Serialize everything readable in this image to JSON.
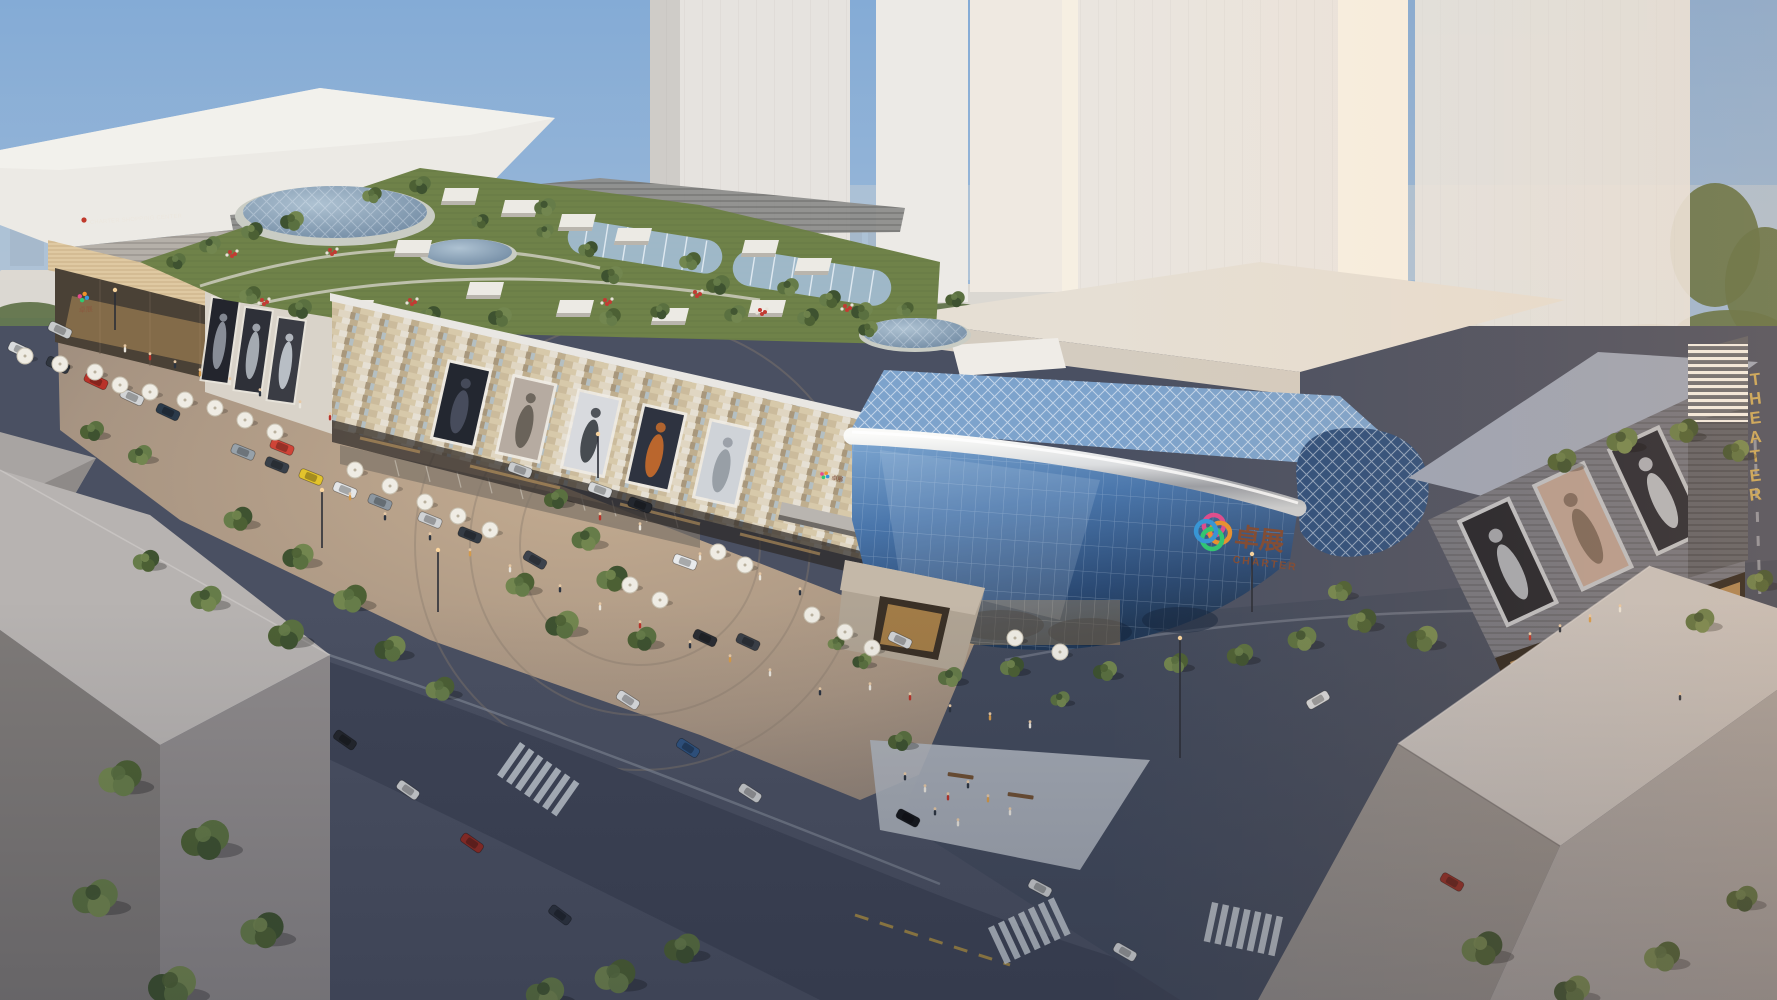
{
  "scene": {
    "signs": {
      "left_building": "CHARTER SHOPPING CENTER",
      "glass_logo_cn": "卓展",
      "glass_logo_en": "CHARTER",
      "theater_vertical": "THEATER"
    },
    "palette": {
      "sky_top": "#84abd6",
      "sky_horizon": "#d9dde0",
      "tower_white": "#eae5df",
      "tower_sunlit": "#f7f0e3",
      "facade_beige": "#cdbd9e",
      "glass_blue": "#3c6399",
      "chrome": "#c9ccd0",
      "roof_green": "#6f8249",
      "plaza_warm": "#b49d8a",
      "asphalt": "#454c5e",
      "gold_sign": "#c9a85c",
      "logo_bronze": "#7e4a34",
      "logo_ring_colors": [
        "#e64a8d",
        "#f0932b",
        "#2ecc71",
        "#3498db"
      ],
      "tree_greens": [
        "#4c6034",
        "#5a7040",
        "#667c49",
        "#3e5230",
        "#72864f"
      ],
      "people_colors": [
        "#e9e5dc",
        "#b93229",
        "#2c3440",
        "#d49a4a",
        "#e9e5dc",
        "#2c3440"
      ]
    },
    "skyline": [
      [
        10,
        222,
        34,
        44
      ],
      [
        52,
        236,
        26,
        30
      ],
      [
        90,
        218,
        20,
        48
      ],
      [
        118,
        238,
        30,
        28
      ],
      [
        155,
        228,
        22,
        38
      ],
      [
        185,
        214,
        16,
        52
      ],
      [
        210,
        234,
        28,
        32
      ],
      [
        245,
        222,
        20,
        44
      ],
      [
        278,
        236,
        26,
        30
      ],
      [
        310,
        226,
        18,
        40
      ],
      [
        340,
        232,
        24,
        34
      ],
      [
        378,
        218,
        16,
        48
      ],
      [
        402,
        234,
        26,
        32
      ],
      [
        438,
        224,
        18,
        42
      ],
      [
        462,
        230,
        22,
        36
      ],
      [
        495,
        236,
        26,
        30
      ],
      [
        530,
        222,
        16,
        44
      ],
      [
        556,
        232,
        24,
        34
      ],
      [
        592,
        226,
        18,
        40
      ],
      [
        620,
        234,
        22,
        32
      ],
      [
        836,
        230,
        26,
        36
      ],
      [
        868,
        220,
        18,
        46
      ],
      [
        896,
        234,
        26,
        32
      ],
      [
        930,
        224,
        18,
        42
      ],
      [
        1000,
        230,
        40,
        34
      ],
      [
        1048,
        236,
        24,
        30
      ]
    ],
    "mid_buildings": [
      [
        0,
        270,
        120,
        48
      ],
      [
        130,
        278,
        90,
        42
      ],
      [
        230,
        284,
        110,
        38
      ],
      [
        350,
        278,
        80,
        42
      ],
      [
        450,
        286,
        90,
        36
      ],
      [
        550,
        280,
        70,
        40
      ],
      [
        835,
        290,
        80,
        38
      ],
      [
        920,
        284,
        90,
        42
      ],
      [
        1010,
        290,
        62,
        36
      ]
    ],
    "bg_trees": [
      [
        30,
        318,
        40,
        16
      ],
      [
        110,
        322,
        50,
        18
      ],
      [
        210,
        326,
        45,
        16
      ],
      [
        320,
        324,
        48,
        17
      ],
      [
        430,
        322,
        42,
        15
      ],
      [
        540,
        324,
        46,
        16
      ],
      [
        620,
        322,
        38,
        14
      ],
      [
        850,
        324,
        44,
        16
      ],
      [
        950,
        320,
        48,
        17
      ],
      [
        1040,
        322,
        40,
        15
      ],
      [
        1450,
        342,
        60,
        20
      ],
      [
        1560,
        347,
        55,
        20
      ],
      [
        1650,
        342,
        50,
        18
      ],
      [
        1730,
        332,
        55,
        22
      ],
      [
        1715,
        245,
        45,
        62
      ],
      [
        1765,
        285,
        40,
        58
      ]
    ],
    "skylights": [
      [
        445,
        188
      ],
      [
        505,
        200
      ],
      [
        562,
        214
      ],
      [
        618,
        228
      ],
      [
        745,
        240
      ],
      [
        798,
        258
      ],
      [
        470,
        282
      ],
      [
        560,
        300
      ],
      [
        655,
        308
      ],
      [
        752,
        300
      ],
      [
        398,
        240
      ],
      [
        340,
        300
      ]
    ],
    "roof_trees": [
      [
        176,
        262,
        0.9
      ],
      [
        210,
        246,
        1
      ],
      [
        252,
        232,
        1
      ],
      [
        292,
        222,
        1.1
      ],
      [
        372,
        196,
        0.9
      ],
      [
        420,
        186,
        1
      ],
      [
        545,
        208,
        1
      ],
      [
        588,
        250,
        0.9
      ],
      [
        612,
        276,
        1
      ],
      [
        690,
        262,
        1
      ],
      [
        718,
        286,
        1.1
      ],
      [
        788,
        288,
        1
      ],
      [
        830,
        300,
        1
      ],
      [
        862,
        312,
        1
      ],
      [
        250,
        296,
        1
      ],
      [
        300,
        310,
        1.1
      ],
      [
        360,
        318,
        1
      ],
      [
        430,
        316,
        1
      ],
      [
        500,
        318,
        1.1
      ],
      [
        610,
        318,
        1
      ],
      [
        660,
        312,
        0.9
      ],
      [
        735,
        315,
        1
      ],
      [
        808,
        318,
        1
      ],
      [
        868,
        330,
        0.9
      ],
      [
        905,
        310,
        0.8
      ],
      [
        955,
        300,
        0.9
      ],
      [
        545,
        232,
        0.8
      ],
      [
        480,
        222,
        0.8
      ]
    ],
    "flowers": [
      [
        230,
        252
      ],
      [
        262,
        300
      ],
      [
        695,
        292
      ],
      [
        845,
        306
      ],
      [
        410,
        300
      ],
      [
        330,
        250
      ],
      [
        605,
        300
      ],
      [
        760,
        310
      ]
    ],
    "billboards_left": [
      {
        "x": 213,
        "y": 298,
        "bg": "#23252d",
        "fig": "#9aa0aa"
      },
      {
        "x": 246,
        "y": 308,
        "bg": "#2e3038",
        "fig": "#b9bfc7"
      },
      {
        "x": 279,
        "y": 318,
        "bg": "#3a3c44",
        "fig": "#cfd5dc"
      }
    ],
    "billboards_main": [
      {
        "x": 450,
        "bg": "#232730",
        "fig": "#4d5464"
      },
      {
        "x": 515,
        "bg": "#b6aba1",
        "fig": "#5d564e"
      },
      {
        "x": 580,
        "bg": "#d8dade",
        "fig": "#2e3238"
      },
      {
        "x": 645,
        "bg": "#2e3340",
        "fig": "#d2702a"
      },
      {
        "x": 712,
        "bg": "#cfd3d8",
        "fig": "#8e959e"
      }
    ],
    "billboards_right": [
      {
        "x": 1462,
        "bg": "#20232c",
        "fig": "#b9bec8"
      },
      {
        "x": 1537,
        "bg": "#b49c90",
        "fig": "#6e5d52"
      },
      {
        "x": 1612,
        "bg": "#262934",
        "fig": "#c8ccd4"
      }
    ],
    "crosswalks": [
      [
        520,
        742,
        35
      ],
      [
        988,
        928,
        -25
      ],
      [
        1212,
        902,
        12
      ],
      [
        30,
        556,
        28
      ]
    ],
    "trees": [
      [
        92,
        432,
        1
      ],
      [
        140,
        456,
        1
      ],
      [
        238,
        520,
        1.2
      ],
      [
        298,
        558,
        1.3
      ],
      [
        350,
        600,
        1.4
      ],
      [
        286,
        636,
        1.5
      ],
      [
        206,
        600,
        1.3
      ],
      [
        146,
        562,
        1.1
      ],
      [
        390,
        650,
        1.3
      ],
      [
        440,
        690,
        1.2
      ],
      [
        556,
        500,
        1
      ],
      [
        586,
        540,
        1.2
      ],
      [
        612,
        580,
        1.3
      ],
      [
        562,
        626,
        1.4
      ],
      [
        520,
        586,
        1.2
      ],
      [
        642,
        640,
        1.2
      ],
      [
        950,
        678,
        1
      ],
      [
        1012,
        668,
        1
      ],
      [
        1105,
        672,
        1
      ],
      [
        1176,
        664,
        1
      ],
      [
        1240,
        656,
        1.1
      ],
      [
        1302,
        640,
        1.2
      ],
      [
        1362,
        622,
        1.2
      ],
      [
        1422,
        640,
        1.3
      ],
      [
        1340,
        592,
        1
      ],
      [
        1562,
        462,
        1.2
      ],
      [
        1622,
        442,
        1.3
      ],
      [
        1684,
        432,
        1.2
      ],
      [
        1736,
        452,
        1.1
      ],
      [
        120,
        780,
        1.8
      ],
      [
        205,
        842,
        2
      ],
      [
        95,
        900,
        1.9
      ],
      [
        262,
        932,
        1.8
      ],
      [
        172,
        988,
        2
      ],
      [
        615,
        978,
        1.7
      ],
      [
        682,
        950,
        1.5
      ],
      [
        545,
        995,
        1.6
      ],
      [
        1482,
        950,
        1.7
      ],
      [
        1572,
        992,
        1.5
      ],
      [
        1662,
        958,
        1.5
      ],
      [
        1742,
        900,
        1.3
      ],
      [
        1700,
        622,
        1.2
      ],
      [
        1760,
        582,
        1.1
      ],
      [
        862,
        662,
        0.8
      ],
      [
        836,
        644,
        0.7
      ],
      [
        900,
        742,
        1
      ],
      [
        1060,
        700,
        0.8
      ]
    ],
    "cars": [
      [
        20,
        350,
        25,
        "#d9dbdd"
      ],
      [
        58,
        365,
        25,
        "#30363f"
      ],
      [
        96,
        381,
        25,
        "#b93229"
      ],
      [
        132,
        397,
        25,
        "#d2d4d6"
      ],
      [
        168,
        412,
        25,
        "#2b3a4a"
      ],
      [
        60,
        330,
        25,
        "#c8cacb"
      ],
      [
        243,
        452,
        22,
        "#97a1a9"
      ],
      [
        277,
        465,
        22,
        "#394049"
      ],
      [
        311,
        477,
        22,
        "#e3c32c"
      ],
      [
        282,
        447,
        22,
        "#cf4437"
      ],
      [
        345,
        490,
        22,
        "#e4e6e8"
      ],
      [
        380,
        502,
        22,
        "#8d97a0"
      ],
      [
        430,
        520,
        22,
        "#d0d2d4"
      ],
      [
        470,
        535,
        22,
        "#343b44"
      ],
      [
        520,
        470,
        20,
        "#c9cbcd"
      ],
      [
        600,
        490,
        20,
        "#d6d8da"
      ],
      [
        640,
        505,
        20,
        "#23272e"
      ],
      [
        685,
        562,
        20,
        "#e8eaec"
      ],
      [
        705,
        638,
        25,
        "#2a2d33"
      ],
      [
        748,
        642,
        25,
        "#3a3f47"
      ],
      [
        345,
        740,
        35,
        "#23262c"
      ],
      [
        408,
        790,
        35,
        "#cdcfd1"
      ],
      [
        472,
        843,
        35,
        "#8e2b24"
      ],
      [
        560,
        915,
        37,
        "#2c323e"
      ],
      [
        628,
        700,
        33,
        "#dadcde"
      ],
      [
        688,
        748,
        33,
        "#2f5380"
      ],
      [
        750,
        793,
        33,
        "#c9cbcd"
      ],
      [
        908,
        818,
        28,
        "#15171c"
      ],
      [
        1040,
        888,
        28,
        "#caccce"
      ],
      [
        1125,
        952,
        30,
        "#d2d4d6"
      ],
      [
        1318,
        700,
        -30,
        "#d8dadc"
      ],
      [
        1452,
        882,
        30,
        "#8e2b24"
      ],
      [
        535,
        560,
        30,
        "#3d434d"
      ],
      [
        900,
        640,
        25,
        "#d0d2d4"
      ]
    ],
    "umbrellas": [
      [
        25,
        356
      ],
      [
        60,
        364
      ],
      [
        95,
        372
      ],
      [
        120,
        385
      ],
      [
        150,
        392
      ],
      [
        185,
        400
      ],
      [
        215,
        408
      ],
      [
        245,
        420
      ],
      [
        275,
        432
      ],
      [
        355,
        470
      ],
      [
        390,
        486
      ],
      [
        425,
        502
      ],
      [
        458,
        516
      ],
      [
        490,
        530
      ],
      [
        718,
        552
      ],
      [
        745,
        565
      ],
      [
        812,
        615
      ],
      [
        845,
        632
      ],
      [
        872,
        648
      ],
      [
        1015,
        638
      ],
      [
        1060,
        652
      ],
      [
        660,
        600
      ],
      [
        630,
        585
      ]
    ],
    "people": [
      [
        125,
        352
      ],
      [
        150,
        360
      ],
      [
        175,
        368
      ],
      [
        200,
        376
      ],
      [
        230,
        385
      ],
      [
        260,
        396
      ],
      [
        300,
        408
      ],
      [
        330,
        420
      ],
      [
        430,
        540
      ],
      [
        470,
        556
      ],
      [
        510,
        572
      ],
      [
        560,
        592
      ],
      [
        600,
        610
      ],
      [
        640,
        628
      ],
      [
        690,
        648
      ],
      [
        730,
        662
      ],
      [
        770,
        676
      ],
      [
        820,
        695
      ],
      [
        870,
        690
      ],
      [
        910,
        700
      ],
      [
        950,
        712
      ],
      [
        990,
        720
      ],
      [
        1030,
        728
      ],
      [
        905,
        780
      ],
      [
        925,
        792
      ],
      [
        948,
        800
      ],
      [
        968,
        788
      ],
      [
        988,
        802
      ],
      [
        1010,
        815
      ],
      [
        935,
        815
      ],
      [
        958,
        826
      ],
      [
        1530,
        640
      ],
      [
        1560,
        632
      ],
      [
        1590,
        622
      ],
      [
        1620,
        612
      ],
      [
        1680,
        700
      ],
      [
        640,
        530
      ],
      [
        600,
        520
      ],
      [
        385,
        520
      ],
      [
        350,
        500
      ],
      [
        760,
        580
      ],
      [
        800,
        595
      ],
      [
        700,
        560
      ]
    ],
    "poles": [
      [
        322,
        548,
        58
      ],
      [
        438,
        612,
        62
      ],
      [
        1180,
        758,
        120
      ],
      [
        1252,
        612,
        58
      ],
      [
        598,
        478,
        44
      ],
      [
        115,
        330,
        40
      ]
    ],
    "benches": [
      [
        948,
        772,
        8
      ],
      [
        1008,
        792,
        8
      ]
    ]
  }
}
